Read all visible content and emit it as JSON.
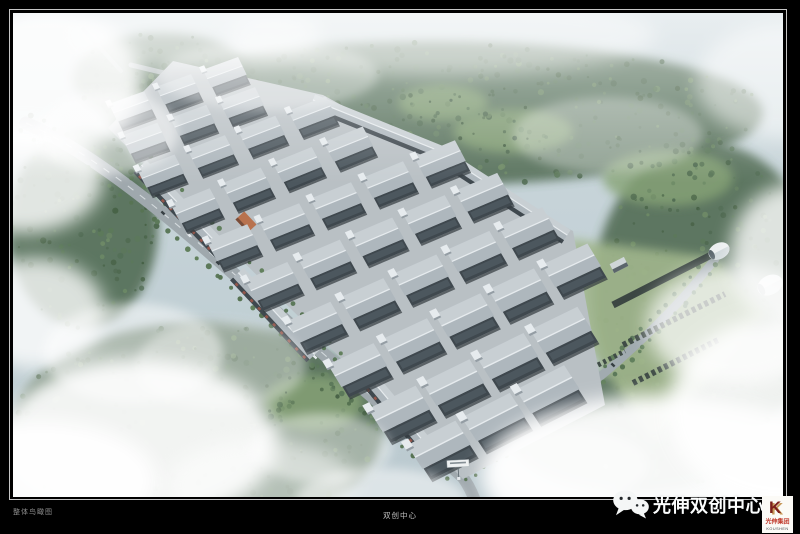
{
  "window": {
    "background": "#000000"
  },
  "frame": {
    "inner_border_color": "#c6c6c6"
  },
  "captions": {
    "left_label": "整体鸟瞰图",
    "center_label": "双创中心"
  },
  "watermark": {
    "title": "光伸双创中心",
    "wechat_icon": "wechat-icon",
    "logo": {
      "monogram": "K",
      "company_cn": "光伸集团",
      "company_en": "KOUSHEN",
      "red": "#c0392b",
      "gold": "#c79a5b",
      "dark_red": "#7d1f1a"
    }
  },
  "scene": {
    "type": "aerial-architectural-rendering",
    "subject": "industrial-park-bird-eye-view",
    "palette": {
      "sky_top": "#ccd9dd",
      "sky_bottom": "#b7c7cc",
      "forest_dark": "#3d5a3c",
      "forest_mid": "#4c6b47",
      "forest_light": "#628156",
      "clearing": "#7d9c67",
      "lawn": "#9ab180",
      "road": "#98a1a6",
      "road_line": "#eef2f4",
      "platform": "#b5bcc0",
      "roof_light": "#c6cdd1",
      "roof_dark": "#a9b2b8",
      "facade": "#2b343a",
      "trim_white": "#e9edef",
      "accent_orange": "#b4643a",
      "cloud": "#ffffff"
    }
  }
}
